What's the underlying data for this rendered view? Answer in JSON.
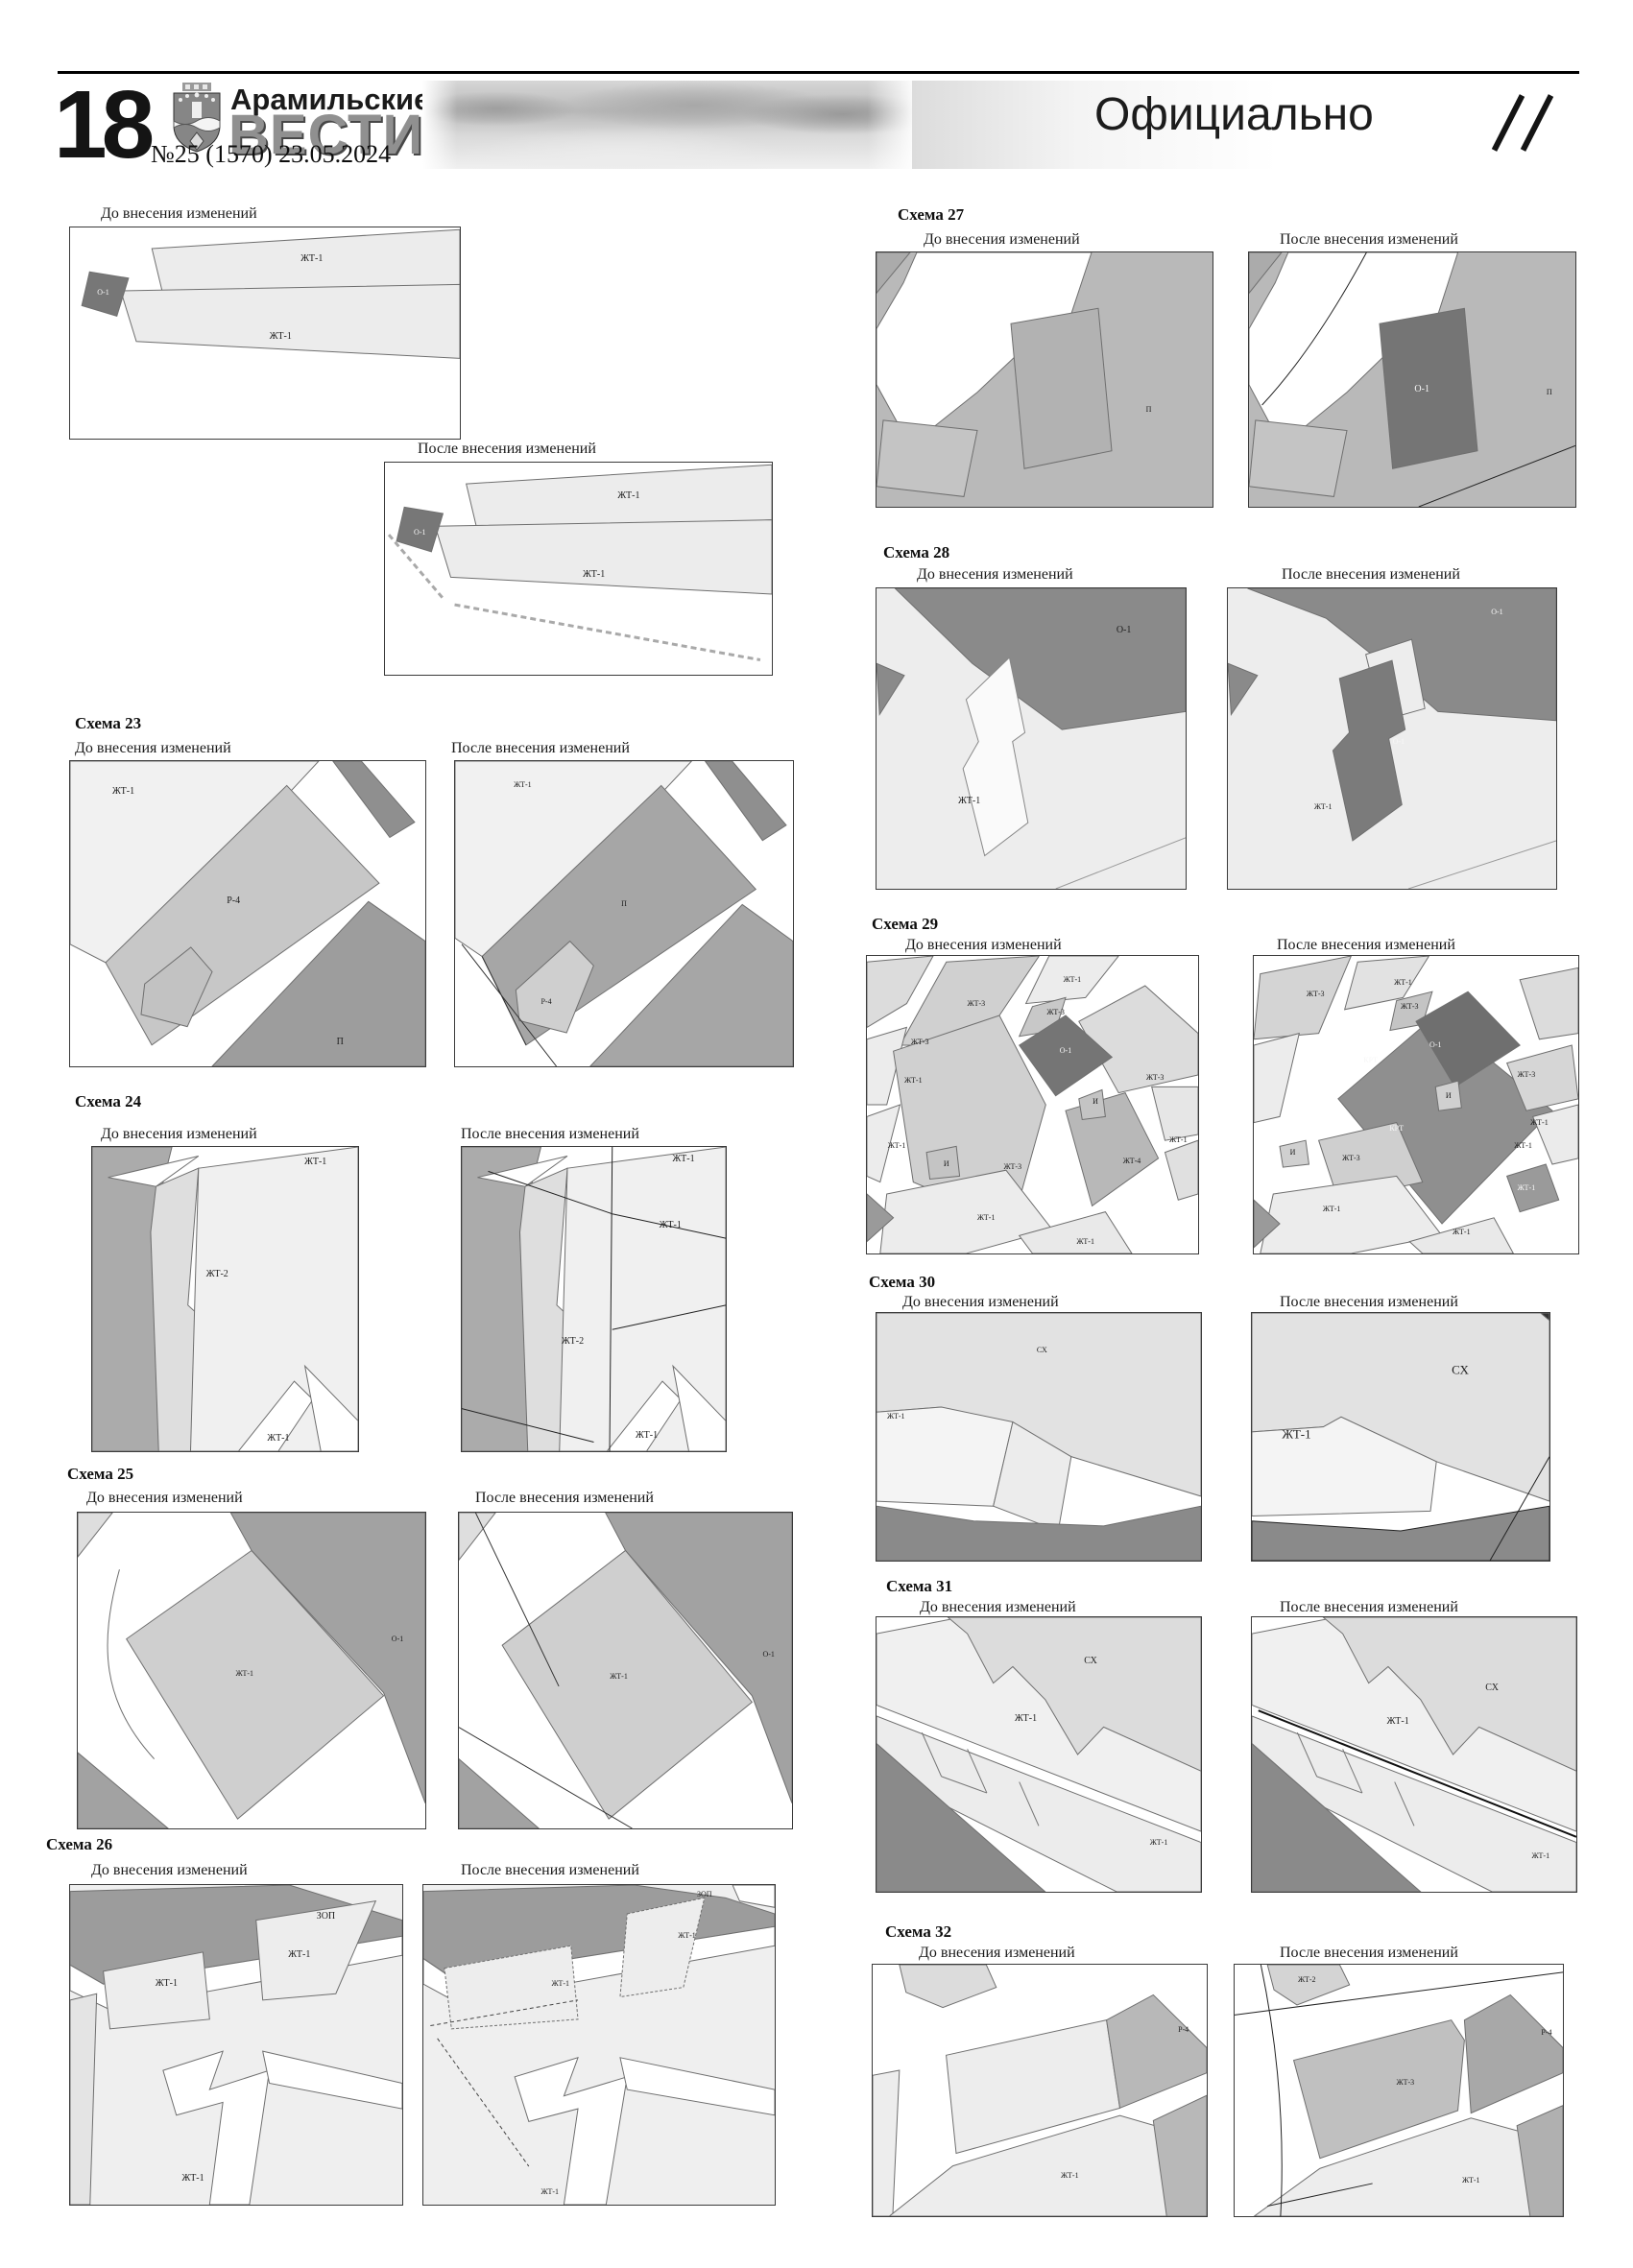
{
  "header": {
    "page_number": "18",
    "paper_top": "Арамильские",
    "paper_bottom": "ВЕСТИ",
    "issue": "№25 (1570) 23.05.2024",
    "section": "Официально"
  },
  "labels": {
    "before": "До внесения изменений",
    "after": "После внесения изменений"
  },
  "schemas": [
    {
      "title": "",
      "bz": [
        "ЖТ-1",
        "ЖТ-1",
        "О-1"
      ],
      "az": [
        "ЖТ-1",
        "ЖТ-1",
        "О-1"
      ]
    },
    {
      "title": "Схема 23",
      "bz": [
        "ЖТ-1",
        "Р-4",
        "П"
      ],
      "az": [
        "ЖТ-1",
        "П",
        "Р-4"
      ]
    },
    {
      "title": "Схема 24",
      "bz": [
        "ЖТ-1",
        "ЖТ-2",
        "ЖТ-1"
      ],
      "az": [
        "ЖТ-1",
        "ЖТ-1",
        "ЖТ-2",
        "ЖТ-1"
      ]
    },
    {
      "title": "Схема 25",
      "bz": [
        "ЖТ-1",
        "О-1"
      ],
      "az": [
        "ЖТ-1",
        "О-1"
      ]
    },
    {
      "title": "Схема 26",
      "bz": [
        "ЗОП",
        "ЖТ-1",
        "ЖТ-1",
        "ЖТ-1"
      ],
      "az": [
        "ЗОП",
        "ЖТ-1",
        "ЖТ-1",
        "ЖТ-1"
      ]
    },
    {
      "title": "Схема 27",
      "bz": [
        "П"
      ],
      "az": [
        "О-1",
        "П"
      ]
    },
    {
      "title": "Схема 28",
      "bz": [
        "О-1",
        "ЖТ-1"
      ],
      "az": [
        "О-1",
        "О-1",
        "ЖТ-1"
      ]
    },
    {
      "title": "Схема 29",
      "bz": [
        "ЖТ-1",
        "ЖТ-3",
        "ЖТ-3",
        "ЖТ-3",
        "О-1",
        "ЖТ-1",
        "ЖТ-3",
        "И",
        "ЖТ-1",
        "И",
        "ЖТ-3",
        "ЖТ-4",
        "ЖТ-1",
        "ЖТ-1",
        "ЖТ-1"
      ],
      "az": [
        "ЖТ-3",
        "ЖТ-1",
        "ЖТ-3",
        "О-1",
        "КРТ",
        "ЖТ-3",
        "И",
        "ЖТ-1",
        "КРТ",
        "И",
        "ЖТ-3",
        "ЖТ-1",
        "ЖТ-1",
        "ЖТ-1",
        "ЖТ-1"
      ]
    },
    {
      "title": "Схема 30",
      "bz": [
        "СХ",
        "ЖТ-1"
      ],
      "az": [
        "СХ",
        "ЖТ-1"
      ]
    },
    {
      "title": "Схема 31",
      "bz": [
        "СХ",
        "ЖТ-1",
        "ЖТ-1"
      ],
      "az": [
        "СХ",
        "ЖТ-1",
        "ЖТ-1"
      ]
    },
    {
      "title": "Схема 32",
      "bz": [
        "Р-4",
        "ЖТ-1"
      ],
      "az": [
        "ЖТ-2",
        "Р-4",
        "ЖТ-3",
        "ЖТ-1"
      ]
    }
  ]
}
